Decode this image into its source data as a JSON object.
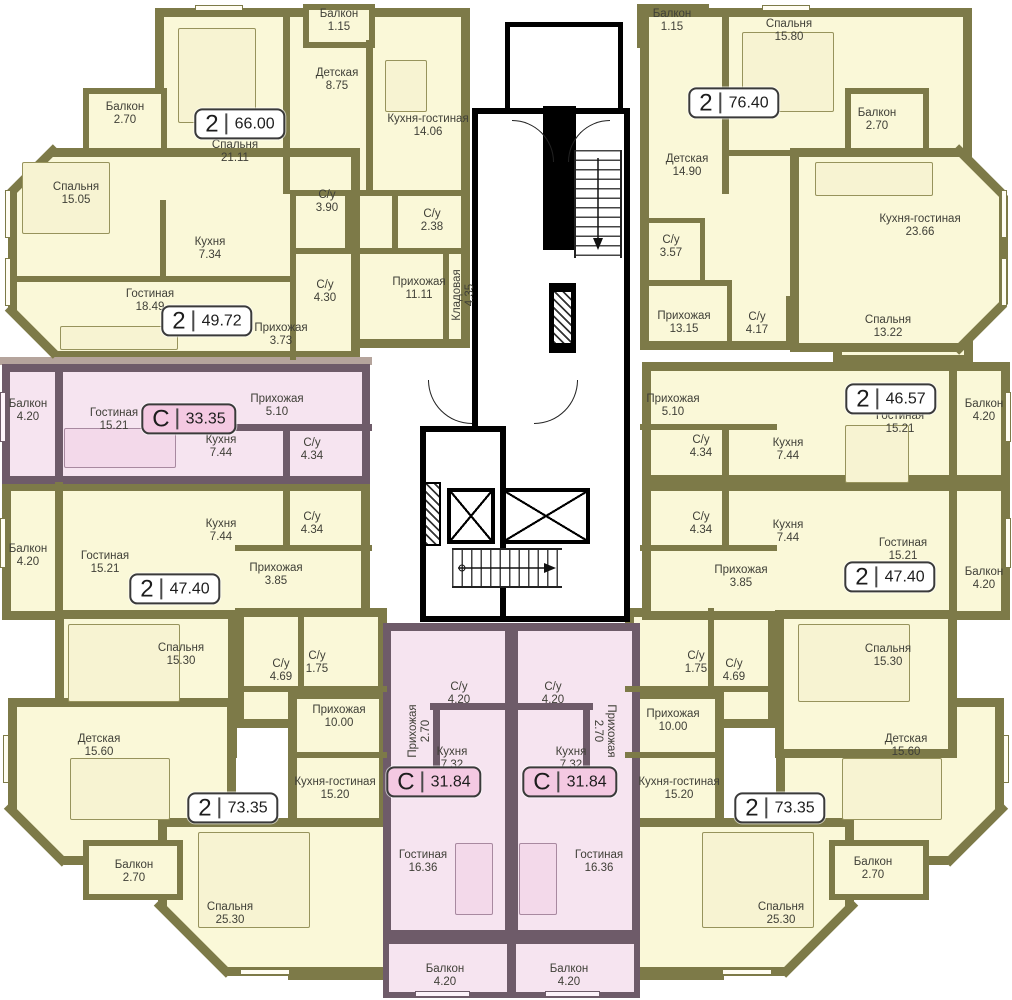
{
  "plan_name": "floor-plan",
  "colors": {
    "wall_olive": "#7d7a48",
    "room_fill": "#faf8d8",
    "studio_fill": "#f6e4f0",
    "studio_wall": "#6e5b69",
    "badge_studio_fill": "#f4c9e2",
    "core_wall": "#000000"
  },
  "apartments": [
    {
      "type": "2",
      "area": "66.00",
      "rooms": [
        {
          "label": "Балкон",
          "area": "1.15"
        },
        {
          "label": "Детская",
          "area": "8.75"
        },
        {
          "label": "Кухня-гостиная",
          "area": "14.06"
        },
        {
          "label": "Спальня",
          "area": "21.11"
        },
        {
          "label": "С/у",
          "area": "3.90"
        },
        {
          "label": "С/у",
          "area": "2.38"
        },
        {
          "label": "Прихожая",
          "area": "11.11"
        },
        {
          "label": "Кладовая",
          "area": "4.35"
        }
      ]
    },
    {
      "type": "2",
      "area": "49.72",
      "rooms": [
        {
          "label": "Балкон",
          "area": "2.70"
        },
        {
          "label": "Спальня",
          "area": "15.05"
        },
        {
          "label": "Кухня",
          "area": "7.34"
        },
        {
          "label": "Гостиная",
          "area": "18.49"
        },
        {
          "label": "С/у",
          "area": "4.30"
        },
        {
          "label": "Прихожая",
          "area": "3.73"
        }
      ]
    },
    {
      "type": "С",
      "area": "33.35",
      "rooms": [
        {
          "label": "Балкон",
          "area": "4.20"
        },
        {
          "label": "Гостиная",
          "area": "15.21"
        },
        {
          "label": "Прихожая",
          "area": "5.10"
        },
        {
          "label": "Кухня",
          "area": "7.44"
        },
        {
          "label": "С/у",
          "area": "4.34"
        }
      ]
    },
    {
      "type": "2",
      "area": "47.40",
      "rooms": [
        {
          "label": "Балкон",
          "area": "4.20"
        },
        {
          "label": "Гостиная",
          "area": "15.21"
        },
        {
          "label": "Кухня",
          "area": "7.44"
        },
        {
          "label": "С/у",
          "area": "4.34"
        },
        {
          "label": "Прихожая",
          "area": "3.85"
        },
        {
          "label": "Спальня",
          "area": "15.30"
        }
      ]
    },
    {
      "type": "2",
      "area": "73.35",
      "rooms": [
        {
          "label": "С/у",
          "area": "4.69"
        },
        {
          "label": "С/у",
          "area": "1.75"
        },
        {
          "label": "Прихожая",
          "area": "10.00"
        },
        {
          "label": "Детская",
          "area": "15.60"
        },
        {
          "label": "Кухня-гостиная",
          "area": "15.20"
        },
        {
          "label": "Балкон",
          "area": "2.70"
        },
        {
          "label": "Спальня",
          "area": "25.30"
        }
      ]
    },
    {
      "type": "С",
      "area": "31.84",
      "rooms": [
        {
          "label": "С/у",
          "area": "4.20"
        },
        {
          "label": "Прихожая",
          "area": "2.70"
        },
        {
          "label": "Кухня",
          "area": "7.32"
        },
        {
          "label": "Гостиная",
          "area": "16.36"
        },
        {
          "label": "Балкон",
          "area": "4.20"
        }
      ]
    },
    {
      "type": "С",
      "area": "31.84",
      "rooms": [
        {
          "label": "С/у",
          "area": "4.20"
        },
        {
          "label": "Прихожая",
          "area": "2.70"
        },
        {
          "label": "Кухня",
          "area": "7.32"
        },
        {
          "label": "Гостиная",
          "area": "16.36"
        },
        {
          "label": "Балкон",
          "area": "4.20"
        }
      ]
    },
    {
      "type": "2",
      "area": "73.35",
      "rooms": [
        {
          "label": "С/у",
          "area": "1.75"
        },
        {
          "label": "С/у",
          "area": "4.69"
        },
        {
          "label": "Прихожая",
          "area": "10.00"
        },
        {
          "label": "Кухня-гостиная",
          "area": "15.20"
        },
        {
          "label": "Детская",
          "area": "15.60"
        },
        {
          "label": "Балкон",
          "area": "2.70"
        },
        {
          "label": "Спальня",
          "area": "25.30"
        }
      ]
    },
    {
      "type": "2",
      "area": "47.40",
      "rooms": [
        {
          "label": "С/у",
          "area": "4.34"
        },
        {
          "label": "Кухня",
          "area": "7.44"
        },
        {
          "label": "Гостиная",
          "area": "15.21"
        },
        {
          "label": "Прихожая",
          "area": "3.85"
        },
        {
          "label": "Балкон",
          "area": "4.20"
        },
        {
          "label": "Спальня",
          "area": "15.30"
        }
      ]
    },
    {
      "type": "2",
      "area": "46.57",
      "rooms": [
        {
          "label": "Спальня",
          "area": "13.22"
        },
        {
          "label": "Прихожая",
          "area": "5.10"
        },
        {
          "label": "С/у",
          "area": "4.34"
        },
        {
          "label": "Кухня",
          "area": "7.44"
        },
        {
          "label": "Гостиная",
          "area": "15.21"
        },
        {
          "label": "Балкон",
          "area": "4.20"
        }
      ]
    },
    {
      "type": "2",
      "area": "76.40",
      "rooms": [
        {
          "label": "Балкон",
          "area": "1.15"
        },
        {
          "label": "Спальня",
          "area": "15.80"
        },
        {
          "label": "Детская",
          "area": "14.90"
        },
        {
          "label": "Балкон",
          "area": "2.70"
        },
        {
          "label": "Кухня-гостиная",
          "area": "23.66"
        },
        {
          "label": "С/у",
          "area": "3.57"
        },
        {
          "label": "Прихожая",
          "area": "13.15"
        },
        {
          "label": "С/у",
          "area": "4.17"
        }
      ]
    }
  ]
}
